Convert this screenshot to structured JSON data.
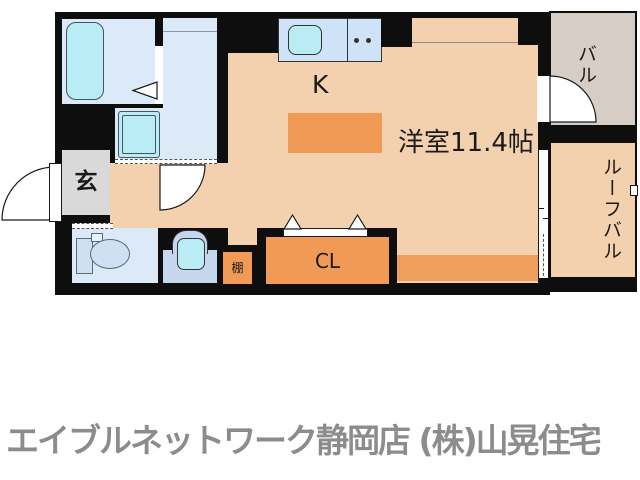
{
  "floorplan": {
    "rooms": {
      "kitchen": {
        "label": "K"
      },
      "living": {
        "label": "洋室11.4帖"
      },
      "entrance": {
        "label": "玄"
      },
      "closet": {
        "label": "CL"
      },
      "shelf": {
        "label": "棚"
      },
      "balcony": {
        "label": "バル"
      },
      "roof_balcony": {
        "label": "ルーフバル"
      }
    },
    "colors": {
      "wall": "#0e0e0e",
      "floor": "#f3d0ae",
      "accent_orange": "#f09a55",
      "band_orange": "#efa05c",
      "room_blue": "#dce9f6",
      "counter_blue": "#cfe3f8",
      "fixture_cyan": "#b9ecf4",
      "basin_blue": "#c6d6ee",
      "toilet_blue": "#cfe0f2",
      "balcony_gray": "#d6cec6",
      "entrance_gray": "#d9d9d9"
    }
  },
  "footer": {
    "agency_text": "エイブルネットワーク静岡店 (株)山晃住宅",
    "text_color": "#8c8c8c"
  }
}
